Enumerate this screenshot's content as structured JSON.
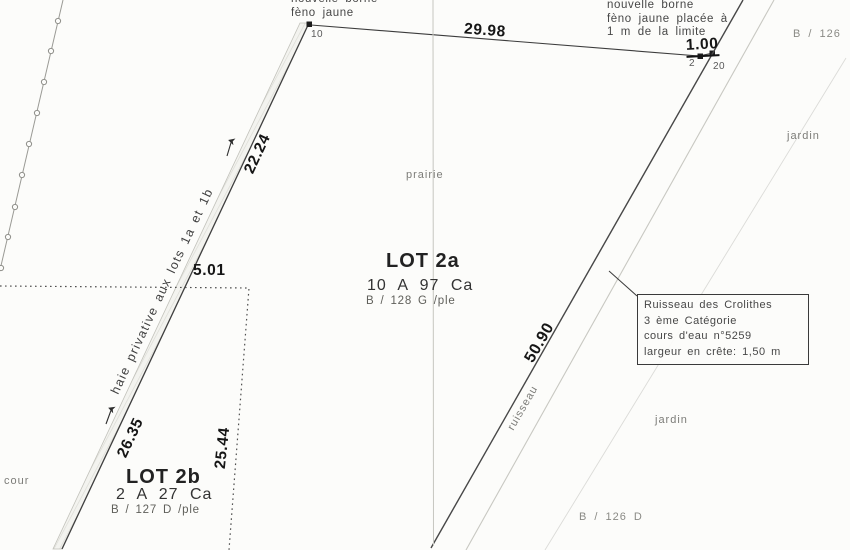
{
  "notes": {
    "borne_left": {
      "l1": "nouvelle borne",
      "l2": "fèno jaune"
    },
    "borne_right": {
      "l1": "nouvelle borne",
      "l2": "fèno jaune placée à",
      "l3": "1 m de la limite"
    }
  },
  "points": {
    "p10": "10",
    "p2": "2",
    "p20": "20"
  },
  "measurements": {
    "seg_29_98": "29.98",
    "seg_1_00": "1.00",
    "seg_22_24": "22.24",
    "seg_5_01": "5.01",
    "seg_26_35": "26.35",
    "seg_25_44": "25.44",
    "seg_50_90": "50.90"
  },
  "lots": {
    "lot2a": {
      "name": "LOT 2a",
      "area": "10 A 97 Ca",
      "ref": "B / 128 G /ple"
    },
    "lot2b": {
      "name": "LOT 2b",
      "area": "2 A 27 Ca",
      "ref": "B / 127 D /ple"
    }
  },
  "land_use": {
    "prairie": "prairie",
    "jardin_top": "jardin",
    "jardin_bottom": "jardin",
    "cour": "cour",
    "ruisseau": "ruisseau",
    "haie": "haie privative aux lots 1a et 1b"
  },
  "cadastral_refs": {
    "b126": "B / 126",
    "b126d": "B / 126 D"
  },
  "stream_info": {
    "l1": "Ruisseau des Crolithes",
    "l2": "3 ème Catégorie",
    "l3": "cours d'eau n°5259",
    "l4": "largeur en crête: 1,50 m"
  },
  "colors": {
    "ink": "#3c3c3c",
    "bold_ink": "#161616",
    "light_line": "#c6c6c0",
    "paper": "#fcfcfa"
  }
}
